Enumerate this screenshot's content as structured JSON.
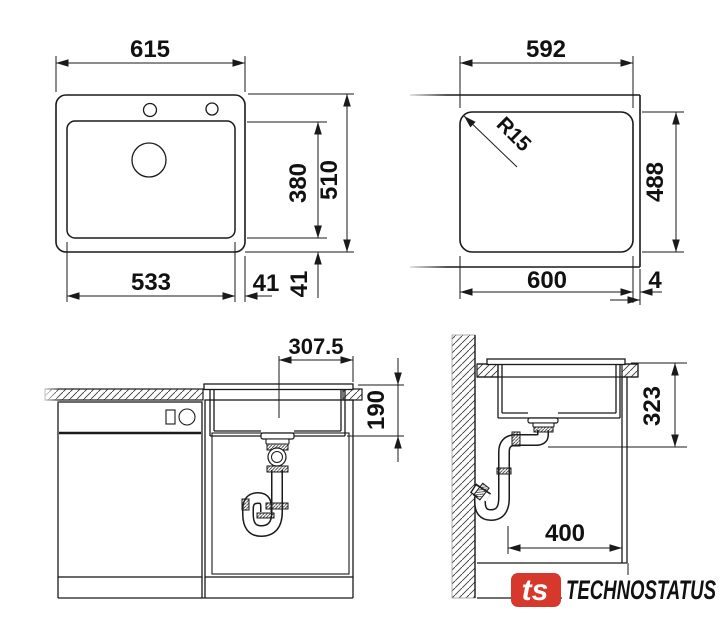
{
  "colors": {
    "line": "#1a1a1a",
    "background": "#ffffff"
  },
  "plan_view": {
    "overall_width": "615",
    "overall_depth": "510",
    "bowl_width": "533",
    "bowl_depth": "380",
    "side_offset": "41",
    "rear_offset": "41"
  },
  "cutout_view": {
    "cutout_width": "592",
    "cutout_depth": "488",
    "outer_width": "600",
    "edge_gap": "4",
    "corner_radius": "R15"
  },
  "front_view": {
    "drain_center_offset": "307.5",
    "bowl_height": "190"
  },
  "side_view": {
    "drain_height": "323",
    "drain_wall_offset": "400"
  },
  "logo": {
    "badge_text": "ts",
    "brand_text": "TECHNOSTATUS",
    "badge_color": "#d6392c",
    "brand_color": "#2c4e74"
  }
}
